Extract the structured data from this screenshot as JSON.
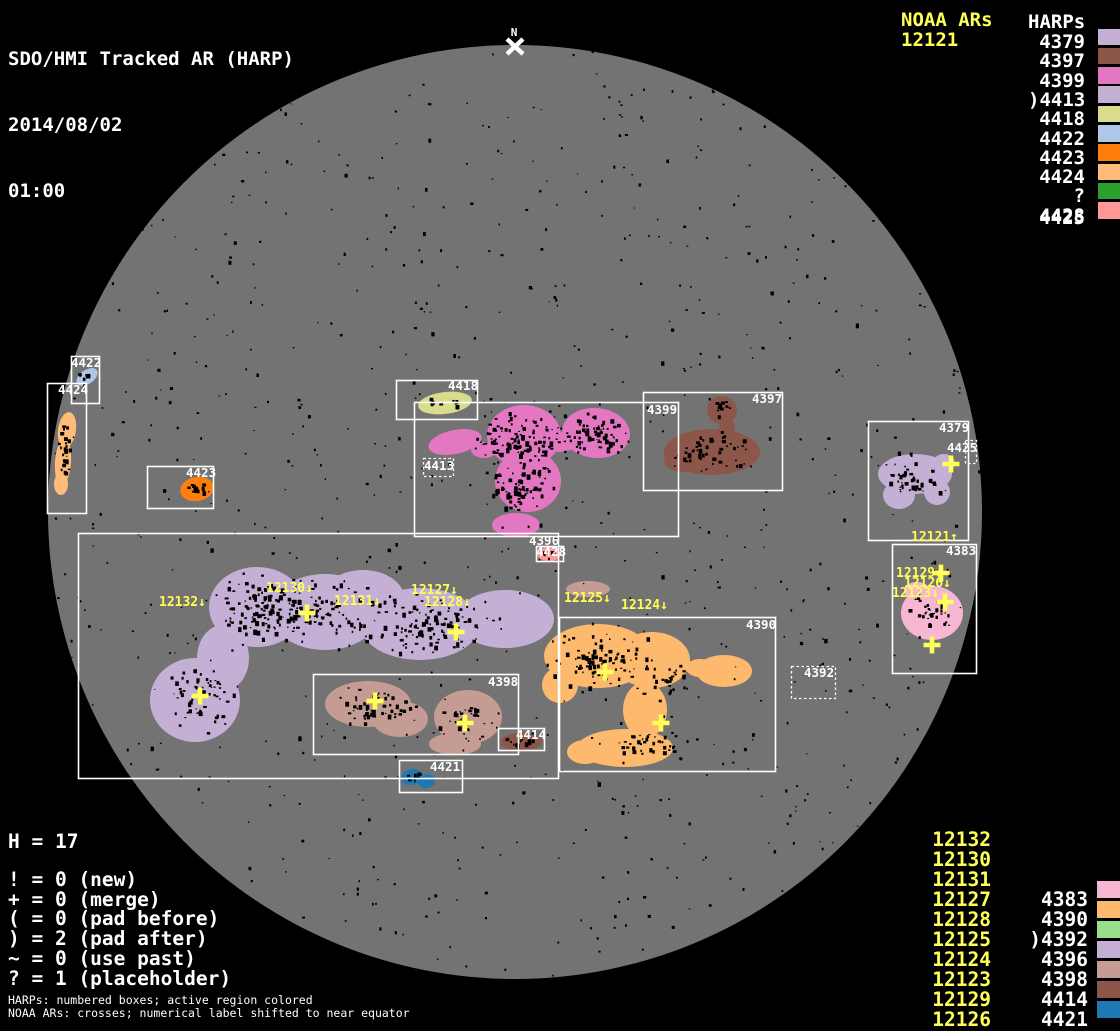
{
  "header": {
    "title": "SDO/HMI Tracked AR (HARP)",
    "date": "2014/08/02",
    "time": "01:00"
  },
  "north": {
    "label": "N"
  },
  "colors": {
    "background": "#000000",
    "disk": "#737373",
    "box_stroke": "#ffffff",
    "accent_yellow": "#ffff55"
  },
  "legend_top_right": {
    "noaa_header": "NOAA ARs",
    "noaa_value": "12121",
    "harps_header": "HARPs",
    "items": [
      {
        "label": "4379",
        "color": "#c5b0d5"
      },
      {
        "label": "4397",
        "color": "#8c564b"
      },
      {
        "label": "4399",
        "color": "#e377c2"
      },
      {
        "label": ")4413",
        "color": "#c5b0d5"
      },
      {
        "label": "4418",
        "color": "#dbdb8d"
      },
      {
        "label": "4422",
        "color": "#aec7e8"
      },
      {
        "label": "4423",
        "color": "#ff7f0e"
      },
      {
        "label": "4424",
        "color": "#ffbb78"
      },
      {
        "label": "?4425",
        "color": "#2ca02c"
      },
      {
        "label": "4428",
        "color": "#ff9896"
      }
    ]
  },
  "legend_bottom_left": {
    "count_line": "H = 17",
    "flags": [
      "! = 0 (new)",
      "+ = 0 (merge)",
      "( = 0 (pad before)",
      ") = 2 (pad after)",
      "~ = 0 (use past)",
      "? = 1 (placeholder)"
    ],
    "footnotes": [
      "HARPs: numbered boxes; active region colored",
      "NOAA ARs: crosses; numerical label shifted to near equator"
    ]
  },
  "legend_bottom_right": {
    "rows": [
      {
        "noaa": "12132"
      },
      {
        "noaa": "12130"
      },
      {
        "noaa": "12131"
      },
      {
        "noaa": "12127",
        "harp": "4383",
        "color": "#f7b6d2"
      },
      {
        "noaa": "12128",
        "harp": "4390",
        "color": "#fdb96d"
      },
      {
        "noaa": "12125",
        "harp": ")4392",
        "color": "#98df8a"
      },
      {
        "noaa": "12124",
        "harp": "4396",
        "color": "#c5b0d5"
      },
      {
        "noaa": "12123",
        "harp": "4398",
        "color": "#c49c94"
      },
      {
        "noaa": "12129",
        "harp": "4414",
        "color": "#8c564b"
      },
      {
        "noaa": "12126",
        "harp": "4421",
        "color": "#1f78b4"
      }
    ]
  },
  "disk": {
    "boxes": [
      {
        "label": "4422",
        "x": 71,
        "y": 356,
        "w": 28,
        "h": 47,
        "lx": 71,
        "ly": 357,
        "dotted": false
      },
      {
        "label": "4424",
        "x": 47,
        "y": 383,
        "w": 39,
        "h": 130,
        "lx": 58,
        "ly": 384,
        "dotted": false
      },
      {
        "label": "4423",
        "x": 147,
        "y": 466,
        "w": 66,
        "h": 42,
        "lx": 186,
        "ly": 467,
        "dotted": false
      },
      {
        "label": "4418",
        "x": 396,
        "y": 380,
        "w": 81,
        "h": 39,
        "lx": 448,
        "ly": 380,
        "dotted": false
      },
      {
        "label": "4413",
        "x": 423,
        "y": 458,
        "w": 30,
        "h": 18,
        "lx": 424,
        "ly": 460,
        "dotted": true
      },
      {
        "label": "4399",
        "x": 414,
        "y": 402,
        "w": 264,
        "h": 134,
        "lx": 647,
        "ly": 404,
        "dotted": false
      },
      {
        "label": "4397",
        "x": 643,
        "y": 392,
        "w": 139,
        "h": 98,
        "lx": 752,
        "ly": 393,
        "dotted": false
      },
      {
        "label": "4379",
        "x": 868,
        "y": 421,
        "w": 100,
        "h": 119,
        "lx": 939,
        "ly": 422,
        "dotted": false
      },
      {
        "label": "4425",
        "x": 965,
        "y": 440,
        "w": 11,
        "h": 23,
        "lx": 947,
        "ly": 442,
        "dotted": true
      },
      {
        "label": "4383",
        "x": 892,
        "y": 544,
        "w": 84,
        "h": 129,
        "lx": 946,
        "ly": 545,
        "dotted": false
      },
      {
        "label": "4392",
        "x": 791,
        "y": 666,
        "w": 44,
        "h": 32,
        "lx": 804,
        "ly": 667,
        "dotted": true
      },
      {
        "label": "4396",
        "x": 78,
        "y": 533,
        "w": 480,
        "h": 245,
        "lx": 529,
        "ly": 535,
        "dotted": false
      },
      {
        "label": "4428",
        "x": 536,
        "y": 546,
        "w": 27,
        "h": 15,
        "lx": 536,
        "ly": 546,
        "dotted": false
      },
      {
        "label": "4398",
        "x": 313,
        "y": 674,
        "w": 205,
        "h": 80,
        "lx": 488,
        "ly": 676,
        "dotted": false
      },
      {
        "label": "4414",
        "x": 498,
        "y": 728,
        "w": 46,
        "h": 22,
        "lx": 516,
        "ly": 729,
        "dotted": false
      },
      {
        "label": "4390",
        "x": 559,
        "y": 617,
        "w": 216,
        "h": 154,
        "lx": 746,
        "ly": 619,
        "dotted": false
      },
      {
        "label": "4421",
        "x": 399,
        "y": 760,
        "w": 63,
        "h": 32,
        "lx": 430,
        "ly": 761,
        "dotted": false
      }
    ],
    "regions": [
      {
        "harp": "4396",
        "color": "#c5b0d5"
      },
      {
        "harp": "4398",
        "color": "#c49c94"
      },
      {
        "harp": "4399",
        "color": "#e377c2"
      },
      {
        "harp": "4397",
        "color": "#8c564b"
      },
      {
        "harp": "4379",
        "color": "#c5b0d5"
      },
      {
        "harp": "4383",
        "color": "#f7b6d2"
      },
      {
        "harp": "4390",
        "color": "#fdb96d"
      },
      {
        "harp": "4414",
        "color": "#8c564b"
      },
      {
        "harp": "4421",
        "color": "#1f78b4"
      },
      {
        "harp": "4428",
        "color": "#ff9896"
      },
      {
        "harp": "4418",
        "color": "#dbdb8d"
      },
      {
        "harp": "4422",
        "color": "#aec7e8"
      },
      {
        "harp": "4423",
        "color": "#ff7f0e"
      },
      {
        "harp": "4424",
        "color": "#ffbb78"
      }
    ],
    "noaa_labels": [
      {
        "text": "12132↓",
        "x": 159,
        "y": 595
      },
      {
        "text": "12130↓",
        "x": 266,
        "y": 581
      },
      {
        "text": "12131↓",
        "x": 334,
        "y": 594
      },
      {
        "text": "12127↓",
        "x": 411,
        "y": 583
      },
      {
        "text": "12128↓",
        "x": 424,
        "y": 595
      },
      {
        "text": "12125↓",
        "x": 564,
        "y": 591
      },
      {
        "text": "12124↓",
        "x": 621,
        "y": 598
      },
      {
        "text": "12121↑",
        "x": 911,
        "y": 530
      },
      {
        "text": "12129↓",
        "x": 896,
        "y": 566
      },
      {
        "text": "12126↓",
        "x": 904,
        "y": 576
      },
      {
        "text": "12123↓",
        "x": 892,
        "y": 586
      }
    ],
    "crosses": [
      {
        "x": 951,
        "y": 464
      },
      {
        "x": 941,
        "y": 573
      },
      {
        "x": 945,
        "y": 602
      },
      {
        "x": 932,
        "y": 645
      },
      {
        "x": 307,
        "y": 613
      },
      {
        "x": 456,
        "y": 632
      },
      {
        "x": 200,
        "y": 696
      },
      {
        "x": 375,
        "y": 701
      },
      {
        "x": 465,
        "y": 723
      },
      {
        "x": 605,
        "y": 672
      },
      {
        "x": 661,
        "y": 723
      }
    ]
  }
}
